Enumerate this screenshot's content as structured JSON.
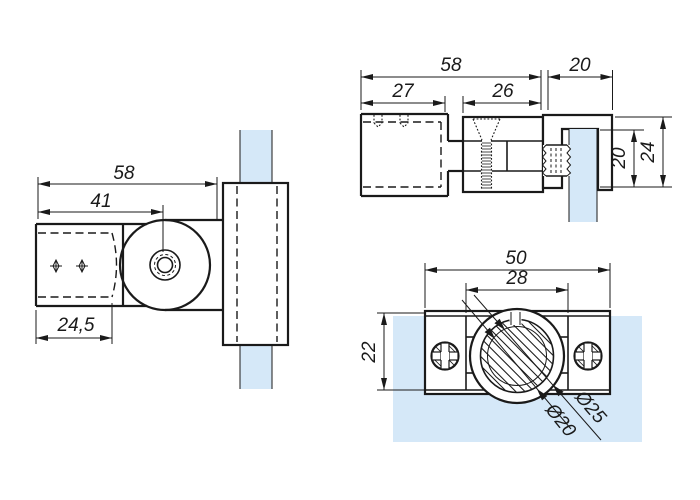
{
  "title": "Glass clamp adapter - dimensioned technical drawing, three views",
  "colors": {
    "glass": "#d5e8f8",
    "line": "#1a1a1a"
  },
  "dims": {
    "side": {
      "total": "58",
      "to_pivot": "41",
      "insert": "24,5"
    },
    "top": {
      "total": "58",
      "clamp_width": "20",
      "socket": "27",
      "body": "26",
      "slot_depth": "20",
      "clamp_height": "24"
    },
    "front": {
      "plate_width": "50",
      "inner_width": "28",
      "plate_height": "22",
      "tube_od": "Ø25",
      "tube_id": "Ø20"
    }
  }
}
